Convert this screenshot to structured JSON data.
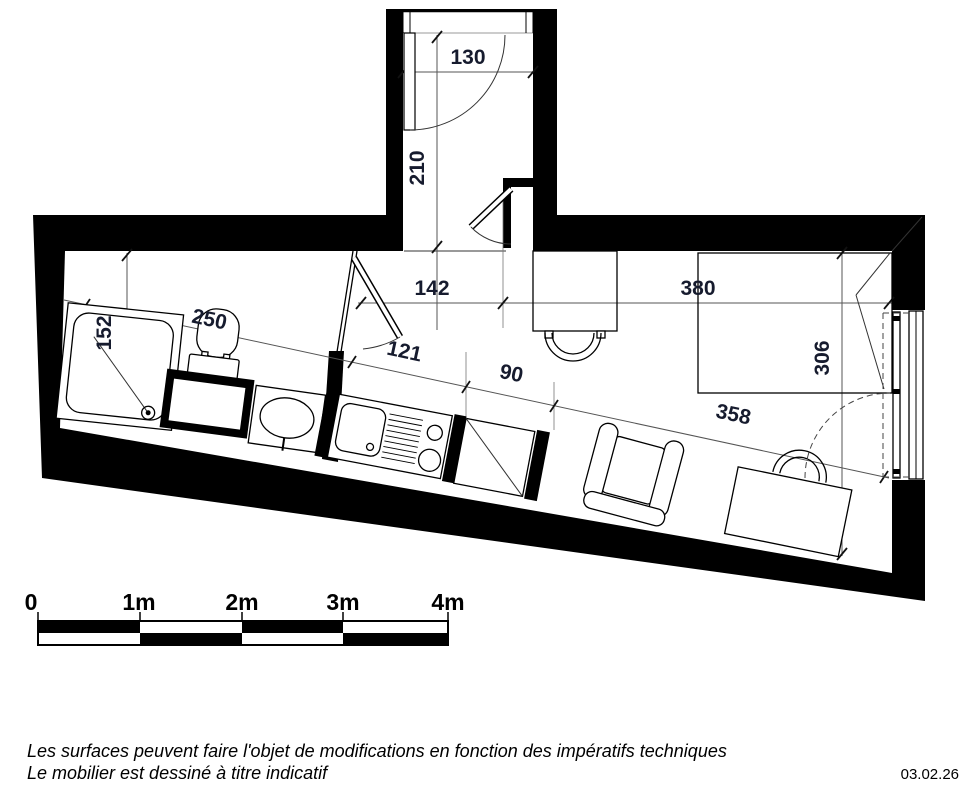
{
  "dimensions": {
    "entry_door_width": "130",
    "entry_hall_depth": "210",
    "hall_width": "142",
    "main_room_width": "380",
    "bathroom_depth": "152",
    "bathroom_length": "250",
    "passage_length": "121",
    "kitchen_length": "90",
    "main_room_depth": "306",
    "living_area_length": "358"
  },
  "scale_bar": {
    "labels": [
      "0",
      "1m",
      "2m",
      "3m",
      "4m"
    ]
  },
  "notes": {
    "line1": "Les surfaces peuvent faire l'objet de modifications en fonction des impératifs techniques",
    "line2": "Le mobilier est dessiné à titre indicatif"
  },
  "date": "03.02.26"
}
